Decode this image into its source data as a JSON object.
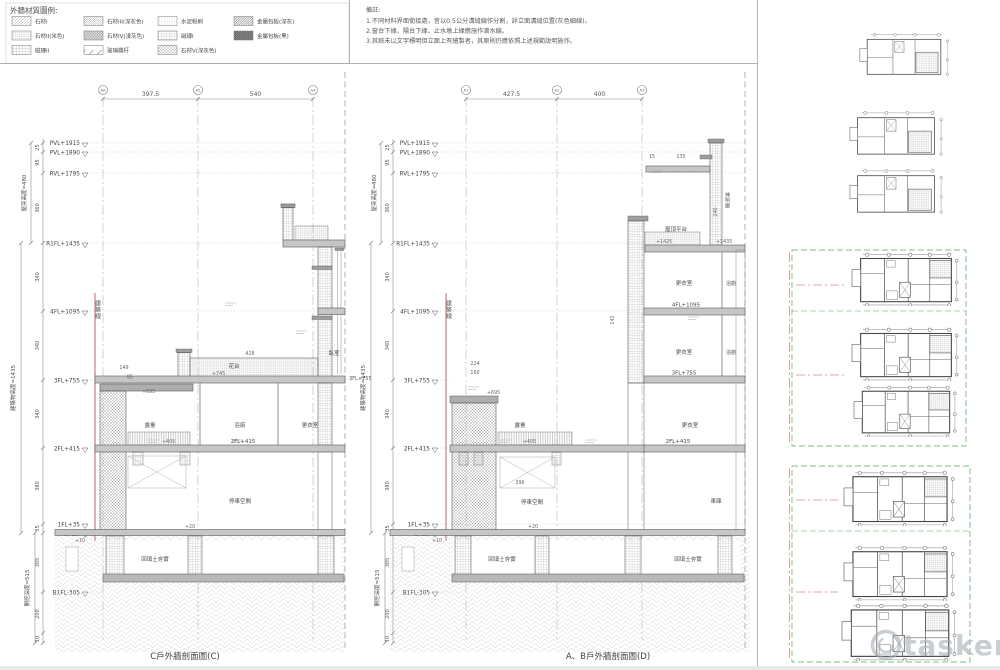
{
  "legend": {
    "title": "外牆材質圖例:",
    "items": [
      {
        "label": "石材I"
      },
      {
        "label": "石材II(米色)"
      },
      {
        "label": "磁磚II"
      },
      {
        "label": "石材III(深灰色)"
      },
      {
        "label": "石材IV(淺灰色)"
      },
      {
        "label": "玻璃欄杆"
      },
      {
        "label": "水泥粉刷"
      },
      {
        "label": "磁磚I"
      },
      {
        "label": "石材V(深灰色)"
      },
      {
        "label": "金屬包板(深灰)"
      },
      {
        "label": "金屬包板(黑)"
      }
    ]
  },
  "notes": {
    "title": "備註:",
    "lines": [
      "1.不同材料界面銜接處，皆以0.5公分溝縫線作分割，詳立面溝縫位置(灰色細線)。",
      "2.窗台下緣、陽台下緣、止水墩上緣應施作滴水線。",
      "3.其餘未以文字標明但立面上有繪製者，其原則仍應依照上述規範說明施作。"
    ]
  },
  "left": {
    "caption": "C戶外牆剖面圖(C)",
    "bubbles": [
      "A6",
      "A5",
      "A4"
    ],
    "top_dims": [
      "397.5",
      "540"
    ],
    "heights": {
      "roof": "屋突高度=480",
      "building": "建築物高度=1435",
      "excavation": "開挖深度=515"
    },
    "levels": [
      "PVL+1915",
      "PVL+1890",
      "RVL+1795",
      "R1FL+1435",
      "4FL+1095",
      "3FL+755",
      "2FL+415",
      "1FL+35",
      "GF±0",
      "B1FL-305"
    ],
    "vdims": [
      "25",
      "95",
      "360",
      "340",
      "340",
      "340",
      "380",
      "35",
      "305",
      "200",
      "10"
    ],
    "texts": {
      "building_line": "建築線",
      "planter": "花台",
      "planter_elev": "+745",
      "bedroom": "臥室",
      "terrace": "露臺",
      "bath": "浴廁",
      "dressing": "更衣室",
      "parking": "停車空間",
      "backfill": "回填土夯實",
      "level_2f": "2FL+415",
      "level_3f": "3FL+755",
      "cap_elev": "+695",
      "deck_elev": "+405",
      "gf_elev": "+10",
      "slab_elev": "+20",
      "dim_428": "428",
      "dim_149": "149",
      "dim_85": "85"
    }
  },
  "right": {
    "caption": "A、B戶外牆剖面圖(D)",
    "bubbles": [
      "A1",
      "A2",
      "A3"
    ],
    "top_dims": [
      "427.5",
      "400"
    ],
    "heights": {
      "roof": "屋突高度=480",
      "building": "建築物高度=1435",
      "excavation": "開挖深度=515"
    },
    "levels": [
      "PVL+1915",
      "PVL+1890",
      "RVL+1795",
      "R1FL+1435",
      "4FL+1095",
      "3FL+755",
      "2FL+415",
      "1FL+35",
      "GF±0",
      "B1FL-305"
    ],
    "vdims": [
      "25",
      "95",
      "360",
      "340",
      "340",
      "340",
      "380",
      "35",
      "305",
      "200",
      "10"
    ],
    "texts": {
      "building_line": "建築線",
      "roof_platform": "屋頂平台",
      "roof_elev1": "+1425",
      "roof_elev2": "+1435",
      "shrine": "神明廳",
      "dressing1": "更衣室",
      "bath1": "浴廁",
      "level_4f": "4FL+1095",
      "dressing2": "更衣室",
      "bath2": "浴廁",
      "level_3f": "3FL+755",
      "dressing3": "更衣室",
      "level_2f": "2FL+415",
      "terrace": "露臺",
      "deck_elev": "+405",
      "cap_elev": "+695",
      "dim_224": "224",
      "dim_160": "160",
      "dim_396": "396",
      "dim_15": "15",
      "dim_135": "135",
      "dim_240": "240",
      "dim_142": "142",
      "parking": "停車空間",
      "garage": "車庫",
      "backfill1": "回填土夯實",
      "backfill2": "回填土夯實",
      "gf_elev": "+10",
      "slab_elev": "+20"
    }
  },
  "watermark": {
    "text": "tasker"
  }
}
